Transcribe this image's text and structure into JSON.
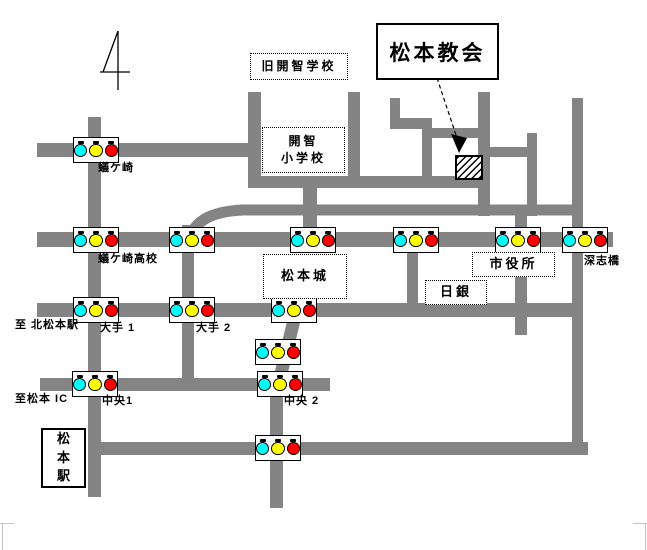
{
  "colors": {
    "road": "#848484",
    "signal_cyan": "#00ffff",
    "signal_yellow": "#ffff00",
    "signal_red": "#ff0000",
    "ink": "#000000",
    "corner_mark": "#c4c4c4"
  },
  "church_box": {
    "label": "松本教会",
    "x": 376,
    "y": 23,
    "w": 119,
    "h": 53
  },
  "map": {
    "signal_lamp_order": [
      "cyan",
      "yellow",
      "red"
    ],
    "roads": [
      {
        "id": "arigasaki-road",
        "x": 37,
        "y": 143,
        "w": 214,
        "h": 14
      },
      {
        "id": "kaichi-south-road",
        "x": 248,
        "y": 176,
        "w": 240,
        "h": 12
      },
      {
        "id": "main-east-west-road",
        "x": 37,
        "y": 232,
        "w": 576,
        "h": 15
      },
      {
        "id": "ote-road",
        "x": 37,
        "y": 303,
        "w": 541,
        "h": 14
      },
      {
        "id": "chuo-road",
        "x": 40,
        "y": 378,
        "w": 290,
        "h": 13
      },
      {
        "id": "station-front-road",
        "x": 88,
        "y": 442,
        "w": 500,
        "h": 13
      },
      {
        "id": "arigasaki-vertical",
        "x": 88,
        "y": 117,
        "w": 13,
        "h": 380
      },
      {
        "id": "ote2-vertical",
        "x": 182,
        "y": 225,
        "w": 12,
        "h": 161
      },
      {
        "id": "kaichi-west-vertical",
        "x": 248,
        "y": 92,
        "w": 13,
        "h": 90
      },
      {
        "id": "kaichi-east-vertical",
        "x": 348,
        "y": 92,
        "w": 12,
        "h": 90
      },
      {
        "id": "castle-west-vertical",
        "x": 303,
        "y": 182,
        "w": 14,
        "h": 65
      },
      {
        "id": "jog-vertical-1",
        "x": 390,
        "y": 98,
        "w": 10,
        "h": 29
      },
      {
        "id": "jog-horizontal-1",
        "x": 390,
        "y": 118,
        "w": 42,
        "h": 11
      },
      {
        "id": "jog-vertical-2",
        "x": 422,
        "y": 127,
        "w": 10,
        "h": 61
      },
      {
        "id": "jog-horizontal-2",
        "x": 432,
        "y": 128,
        "w": 56,
        "h": 10
      },
      {
        "id": "church-west-vertical",
        "x": 478,
        "y": 92,
        "w": 12,
        "h": 124
      },
      {
        "id": "church-mid-link",
        "x": 490,
        "y": 147,
        "w": 45,
        "h": 10
      },
      {
        "id": "church-east-vertical",
        "x": 527,
        "y": 133,
        "w": 10,
        "h": 83
      },
      {
        "id": "shiyakusho-vertical",
        "x": 515,
        "y": 212,
        "w": 12,
        "h": 123
      },
      {
        "id": "nichigin-vertical",
        "x": 407,
        "y": 240,
        "w": 11,
        "h": 70
      },
      {
        "id": "river-road",
        "x": 572,
        "y": 98,
        "w": 11,
        "h": 357
      },
      {
        "id": "chuo2-south-vertical",
        "x": 270,
        "y": 388,
        "w": 13,
        "h": 120
      }
    ],
    "curve": "M 189,243 Q 193,212 243,210 L 583,210",
    "diagonal": {
      "x1": 295,
      "y1": 316,
      "x2": 277,
      "y2": 390
    },
    "signals": [
      {
        "id": "signal-arigasaki",
        "cx": 95,
        "cy": 150
      },
      {
        "id": "signal-arigasaki-koko",
        "cx": 95,
        "cy": 240
      },
      {
        "id": "signal-ote2-north",
        "cx": 191,
        "cy": 240
      },
      {
        "id": "signal-castle-west",
        "cx": 312,
        "cy": 240
      },
      {
        "id": "signal-nichigin-north",
        "cx": 415,
        "cy": 240
      },
      {
        "id": "signal-shiyakusho-west",
        "cx": 517,
        "cy": 240
      },
      {
        "id": "signal-fukashibashi",
        "cx": 584,
        "cy": 240
      },
      {
        "id": "signal-ote1",
        "cx": 95,
        "cy": 310
      },
      {
        "id": "signal-ote2",
        "cx": 191,
        "cy": 310
      },
      {
        "id": "signal-castle-south",
        "cx": 293,
        "cy": 310
      },
      {
        "id": "signal-mid-diagonal",
        "cx": 277,
        "cy": 352
      },
      {
        "id": "signal-chuo1",
        "cx": 94,
        "cy": 384
      },
      {
        "id": "signal-chuo2",
        "cx": 279,
        "cy": 384
      },
      {
        "id": "signal-station-front",
        "cx": 277,
        "cy": 448
      }
    ],
    "labels": [
      {
        "id": "arigasaki",
        "text": "蟻ケ崎",
        "x": 98,
        "y": 162
      },
      {
        "id": "arigasaki-koko",
        "text": "蟻ケ崎高校",
        "x": 98,
        "y": 253
      },
      {
        "id": "kita-matsumoto",
        "text": "至 北松本駅",
        "x": 15,
        "y": 319
      },
      {
        "id": "ote-1",
        "text": "大手 1",
        "x": 100,
        "y": 322
      },
      {
        "id": "ote-2",
        "text": "大手 2",
        "x": 196,
        "y": 322
      },
      {
        "id": "matsumoto-ic",
        "text": "至松本 IC",
        "x": 15,
        "y": 393
      },
      {
        "id": "chuo-1",
        "text": "中央1",
        "x": 102,
        "y": 395
      },
      {
        "id": "chuo-2",
        "text": "中央 2",
        "x": 284,
        "y": 395
      },
      {
        "id": "fukashi-bashi",
        "text": "深志橋",
        "x": 584,
        "y": 255
      }
    ],
    "landmarks": [
      {
        "id": "kyu-kaichi-gakko",
        "lines": [
          "旧開智学校"
        ],
        "style": "dotted",
        "x": 250,
        "y": 53,
        "w": 98,
        "h": 27,
        "font": 12
      },
      {
        "id": "kaichi-shogakko",
        "lines": [
          "開智",
          "小学校"
        ],
        "style": "dotted",
        "x": 262,
        "y": 127,
        "w": 83,
        "h": 46,
        "font": 12
      },
      {
        "id": "matsumoto-jo",
        "lines": [
          "松本城"
        ],
        "style": "dotted",
        "x": 263,
        "y": 254,
        "w": 84,
        "h": 45,
        "font": 13
      },
      {
        "id": "shiyakusho",
        "lines": [
          "市役所"
        ],
        "style": "dotted",
        "x": 472,
        "y": 252,
        "w": 83,
        "h": 25,
        "font": 13
      },
      {
        "id": "nichigin",
        "lines": [
          "日銀"
        ],
        "style": "dotted",
        "x": 425,
        "y": 280,
        "w": 62,
        "h": 25,
        "font": 13
      },
      {
        "id": "matsumoto-eki",
        "lines": [
          "松",
          "本",
          "駅"
        ],
        "style": "solid",
        "x": 41,
        "y": 428,
        "w": 45,
        "h": 60,
        "font": 13
      }
    ],
    "church_site": {
      "x": 455,
      "y": 155,
      "w": 24,
      "h": 21
    },
    "arrow": {
      "x1": 437,
      "y1": 78,
      "x2": 457,
      "y2": 138,
      "head": "451,134 467,138 459,153"
    },
    "north_symbol": {
      "lines": [
        [
          118,
          31,
          118,
          90
        ],
        [
          118,
          31,
          103,
          72
        ],
        [
          100,
          72,
          130,
          72
        ]
      ]
    }
  }
}
